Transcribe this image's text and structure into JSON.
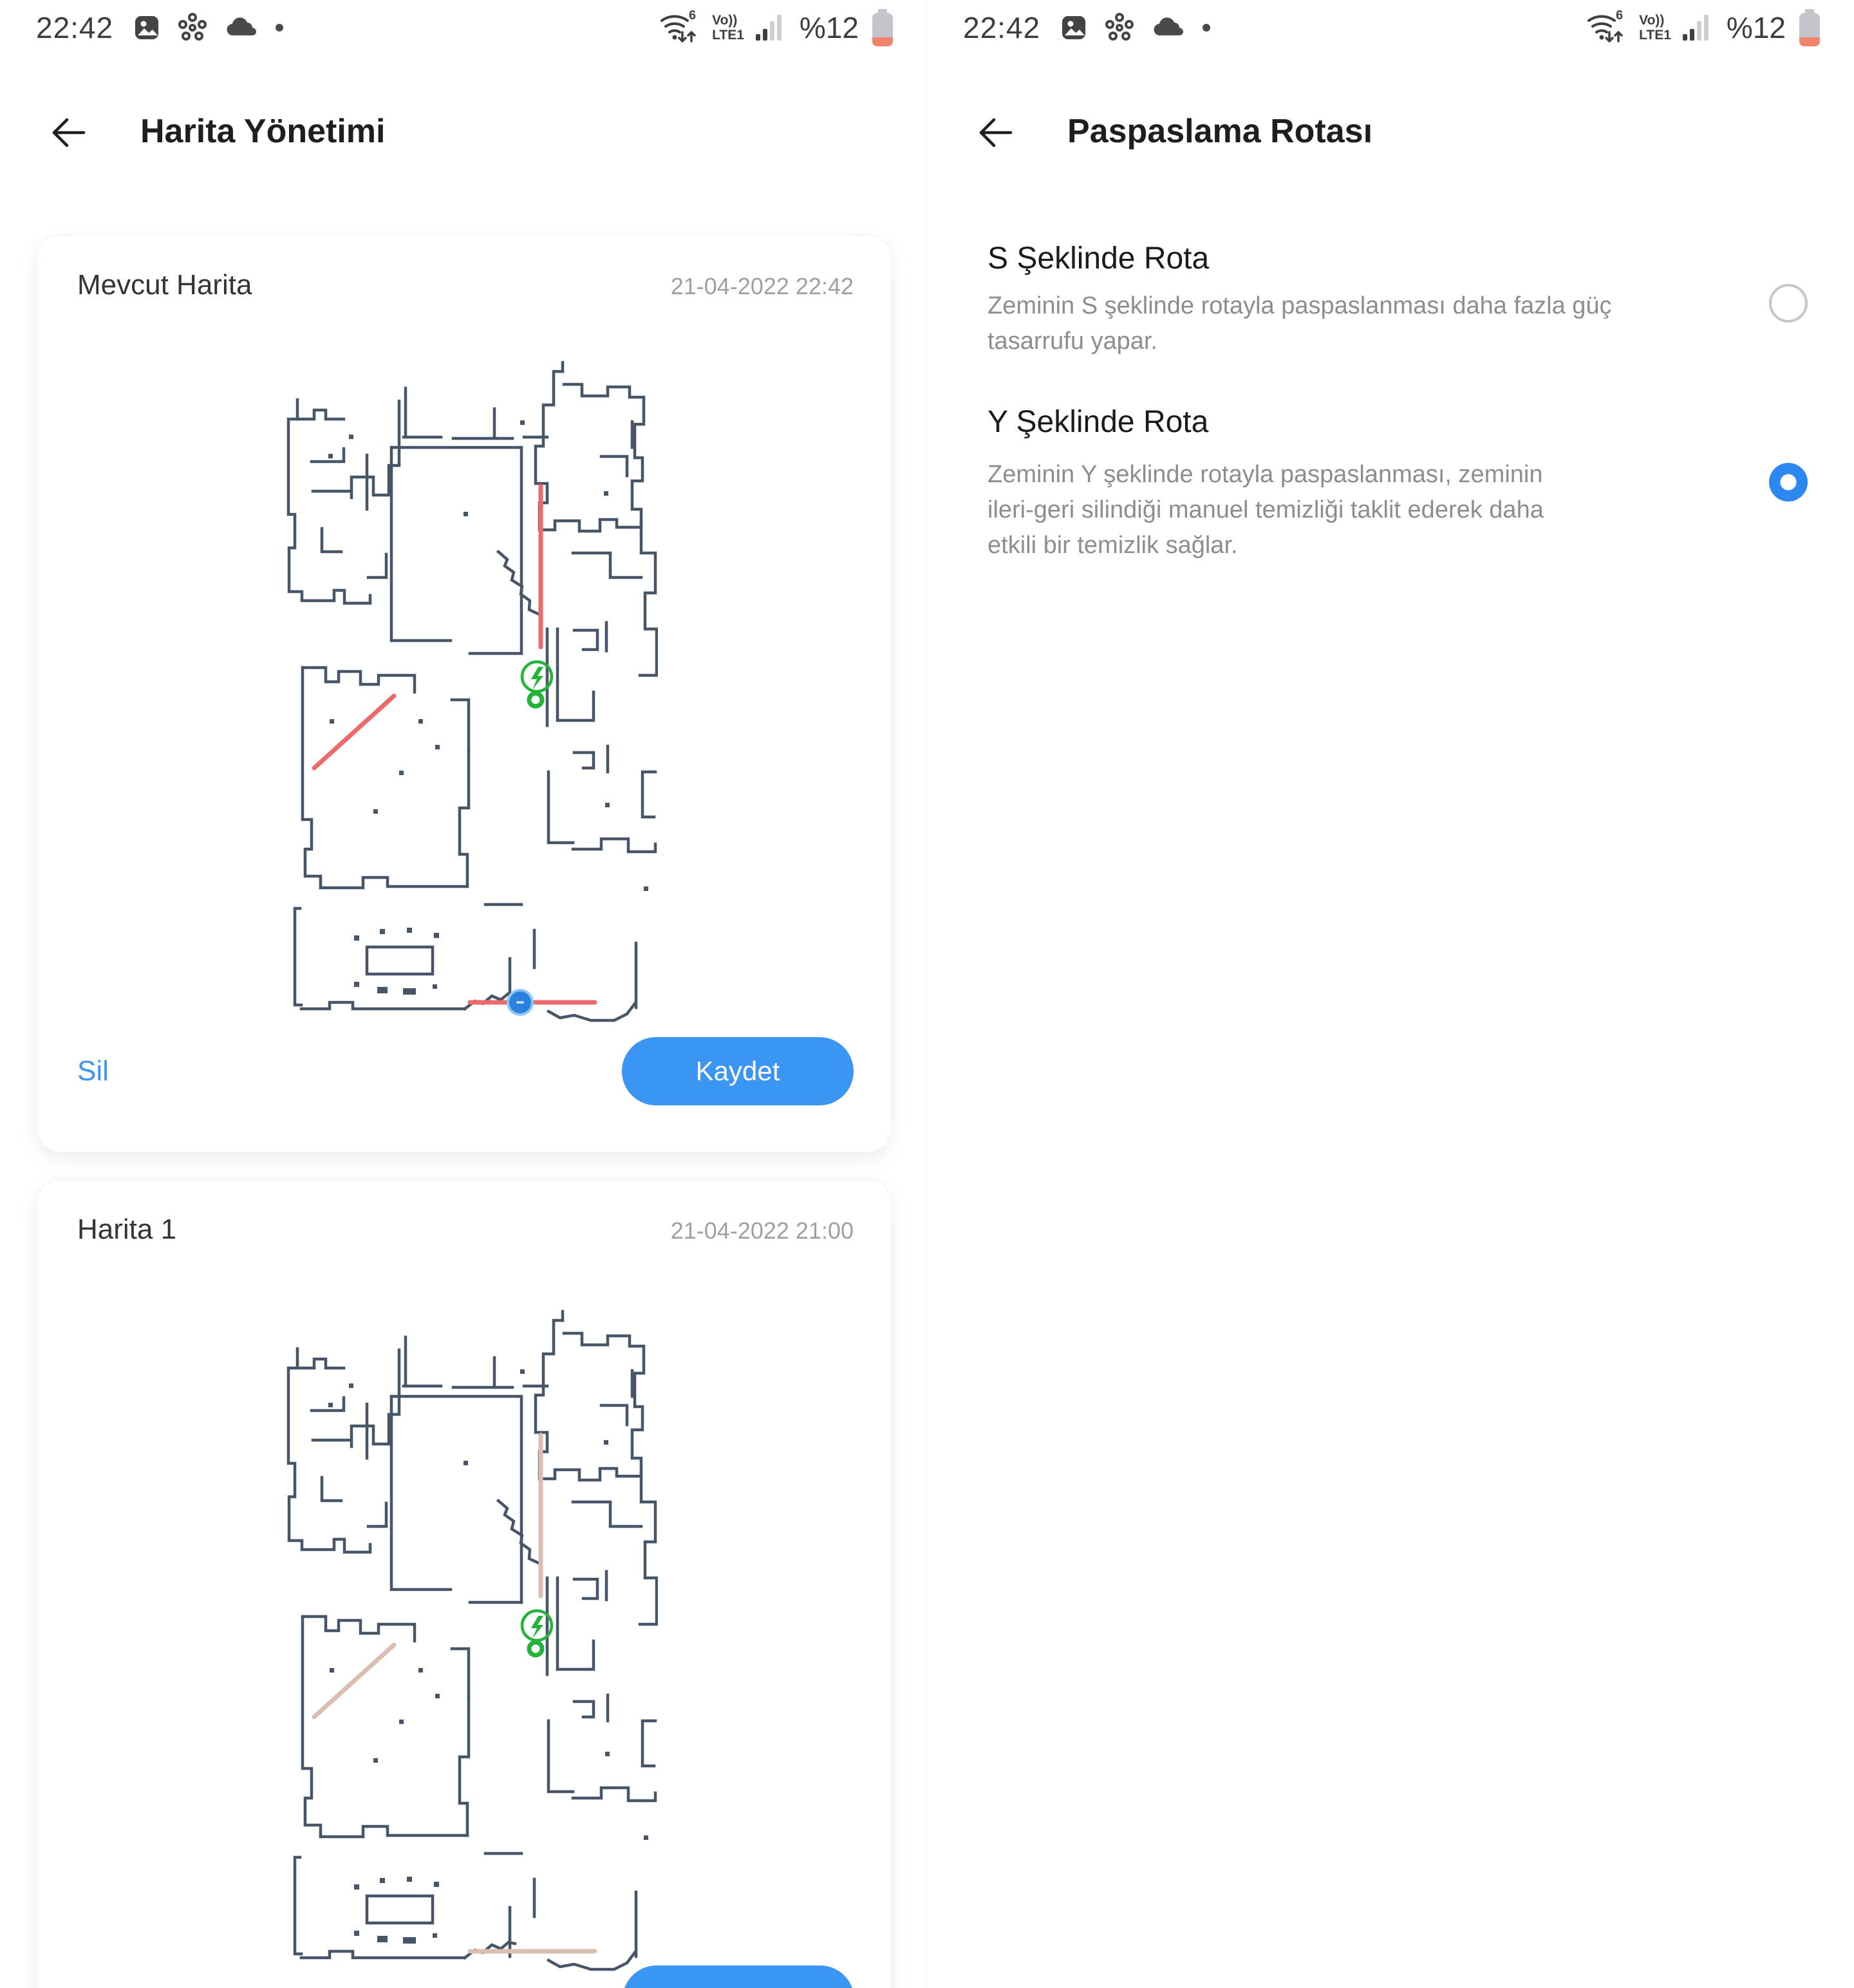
{
  "status_bar": {
    "time": "22:42",
    "wifi_band": "6",
    "volte_label": "Vo))",
    "network_label": "LTE1",
    "battery_percent": "%12"
  },
  "map_management": {
    "title": "Harita Yönetimi",
    "cards": [
      {
        "title": "Mevcut Harita",
        "timestamp": "21-04-2022 22:42",
        "delete_label": "Sil",
        "save_label": "Kaydet"
      },
      {
        "title": "Harita 1",
        "timestamp": "21-04-2022 21:00"
      }
    ]
  },
  "mopping_route": {
    "title": "Paspaslama Rotası",
    "options": [
      {
        "title": "S Şeklinde Rota",
        "description_lines": [
          "Zeminin S şeklinde rotayla paspaslanması daha fazla güç",
          "tasarrufu yapar."
        ],
        "selected": false
      },
      {
        "title": "Y Şeklinde Rota",
        "description_lines": [
          "Zeminin Y şeklinde rotayla paspaslanması, zeminin",
          "ileri-geri silindiği manuel temizliği taklit ederek daha",
          "etkili bir temizlik sağlar."
        ],
        "selected": true
      }
    ]
  },
  "map_legend": {
    "wall_color": "#475569",
    "no_go_line_color": "#ed6a6a",
    "faded_line_color": "#d9beb1",
    "charger_color": "#23b33a",
    "robot_color": "#2b82dd",
    "accent_blue": "#3b96f3"
  }
}
